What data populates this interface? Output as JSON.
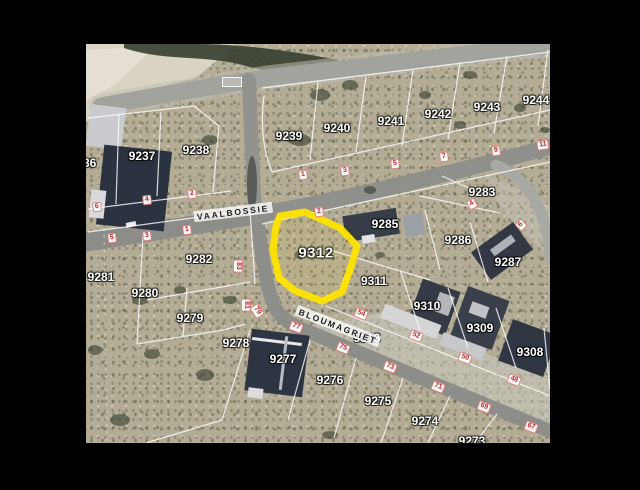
{
  "frame": {
    "background": "#000000"
  },
  "viewport": {
    "x": 86,
    "y": 44,
    "width": 464,
    "height": 399
  },
  "map": {
    "highlighted_parcel": {
      "id": "9312",
      "outline_color": "#ffe400"
    },
    "streets": [
      {
        "name": "VAALBOSSIE",
        "x": 147,
        "y": 168,
        "rot": -7
      },
      {
        "name": "BLOUMAGRIET",
        "x": 252,
        "y": 282,
        "rot": 21
      }
    ],
    "parcels": [
      {
        "id": "9236",
        "x": -3,
        "y": 119
      },
      {
        "id": "9237",
        "x": 56,
        "y": 112
      },
      {
        "id": "9238",
        "x": 110,
        "y": 106
      },
      {
        "id": "9239",
        "x": 203,
        "y": 92
      },
      {
        "id": "9240",
        "x": 251,
        "y": 84
      },
      {
        "id": "9241",
        "x": 305,
        "y": 77
      },
      {
        "id": "9242",
        "x": 352,
        "y": 70
      },
      {
        "id": "9243",
        "x": 401,
        "y": 63
      },
      {
        "id": "9244",
        "x": 450,
        "y": 56
      },
      {
        "id": "9283",
        "x": 396,
        "y": 148
      },
      {
        "id": "9285",
        "x": 299,
        "y": 180
      },
      {
        "id": "9286",
        "x": 372,
        "y": 196
      },
      {
        "id": "9287",
        "x": 422,
        "y": 218
      },
      {
        "id": "9282",
        "x": 113,
        "y": 215
      },
      {
        "id": "9281",
        "x": 15,
        "y": 233
      },
      {
        "id": "9280",
        "x": 59,
        "y": 249
      },
      {
        "id": "9279",
        "x": 104,
        "y": 274
      },
      {
        "id": "9278",
        "x": 150,
        "y": 299
      },
      {
        "id": "9312",
        "x": 230,
        "y": 209
      },
      {
        "id": "9311",
        "x": 288,
        "y": 237
      },
      {
        "id": "9310",
        "x": 341,
        "y": 262
      },
      {
        "id": "9309",
        "x": 394,
        "y": 284
      },
      {
        "id": "9308",
        "x": 444,
        "y": 308
      },
      {
        "id": "9313",
        "x": 281,
        "y": 294
      },
      {
        "id": "9277",
        "x": 197,
        "y": 315
      },
      {
        "id": "9276",
        "x": 244,
        "y": 336
      },
      {
        "id": "9275",
        "x": 292,
        "y": 357
      },
      {
        "id": "9274",
        "x": 339,
        "y": 377
      },
      {
        "id": "9273",
        "x": 386,
        "y": 397
      }
    ],
    "house_numbers": [
      {
        "n": "6",
        "x": 11,
        "y": 163,
        "rot": -7
      },
      {
        "n": "4",
        "x": 61,
        "y": 156,
        "rot": -7
      },
      {
        "n": "2",
        "x": 106,
        "y": 150,
        "rot": -7
      },
      {
        "n": "5",
        "x": 26,
        "y": 194,
        "rot": -7
      },
      {
        "n": "3",
        "x": 61,
        "y": 192,
        "rot": -7
      },
      {
        "n": "1",
        "x": 101,
        "y": 186,
        "rot": -7
      },
      {
        "n": "1",
        "x": 217,
        "y": 131,
        "rot": -8
      },
      {
        "n": "3",
        "x": 259,
        "y": 127,
        "rot": -8
      },
      {
        "n": "5",
        "x": 309,
        "y": 120,
        "rot": -8
      },
      {
        "n": "7",
        "x": 358,
        "y": 113,
        "rot": -8
      },
      {
        "n": "9",
        "x": 410,
        "y": 107,
        "rot": -8
      },
      {
        "n": "11",
        "x": 457,
        "y": 101,
        "rot": -8
      },
      {
        "n": "2",
        "x": 233,
        "y": 168,
        "rot": -8
      },
      {
        "n": "4",
        "x": 386,
        "y": 160,
        "rot": -30
      },
      {
        "n": "6",
        "x": 435,
        "y": 181,
        "rot": -45
      },
      {
        "n": "83",
        "x": 152,
        "y": 222,
        "rot": 90
      },
      {
        "n": "81",
        "x": 160,
        "y": 261,
        "rot": 90
      },
      {
        "n": "79",
        "x": 171,
        "y": 267,
        "rot": 55
      },
      {
        "n": "77",
        "x": 210,
        "y": 283,
        "rot": 21
      },
      {
        "n": "75",
        "x": 257,
        "y": 304,
        "rot": 21
      },
      {
        "n": "73",
        "x": 304,
        "y": 323,
        "rot": 21
      },
      {
        "n": "71",
        "x": 352,
        "y": 343,
        "rot": 21
      },
      {
        "n": "69",
        "x": 398,
        "y": 363,
        "rot": 21
      },
      {
        "n": "67",
        "x": 445,
        "y": 383,
        "rot": 21
      },
      {
        "n": "54",
        "x": 275,
        "y": 270,
        "rot": 21
      },
      {
        "n": "52",
        "x": 330,
        "y": 292,
        "rot": 21
      },
      {
        "n": "50",
        "x": 379,
        "y": 314,
        "rot": 21
      },
      {
        "n": "48",
        "x": 428,
        "y": 336,
        "rot": 21
      }
    ]
  }
}
